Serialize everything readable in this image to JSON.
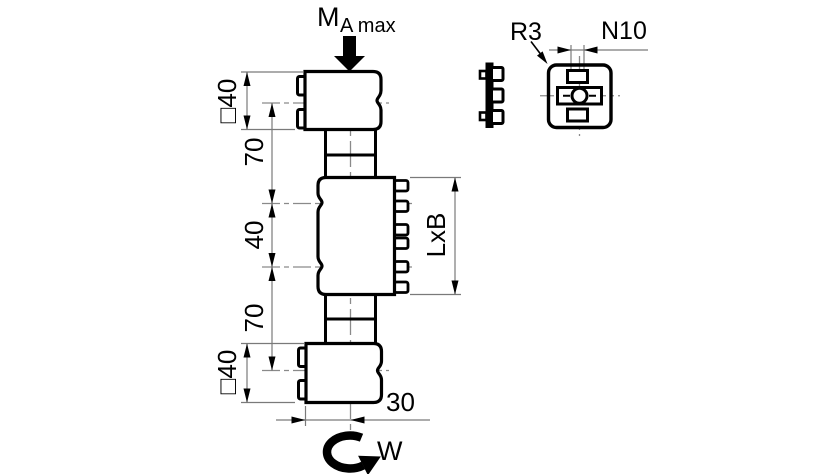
{
  "main_view": {
    "moment_label": {
      "symbol": "M",
      "subscript": "A max"
    },
    "dimensions": {
      "top_block_size": "□40",
      "upper_spacing": "70",
      "center_spacing": "40",
      "lower_spacing": "70",
      "bottom_block_size": "□40",
      "lateral_offset": "30",
      "clamp_area": "LxB"
    },
    "rotation_label": "W"
  },
  "detail_view": {
    "corner_radius": "R3",
    "groove_size": "N10"
  },
  "colors": {
    "outline": "#000000",
    "thin_line": "#7a7a7a",
    "centerline": "#8a8a8a",
    "background": "#ffffff"
  }
}
